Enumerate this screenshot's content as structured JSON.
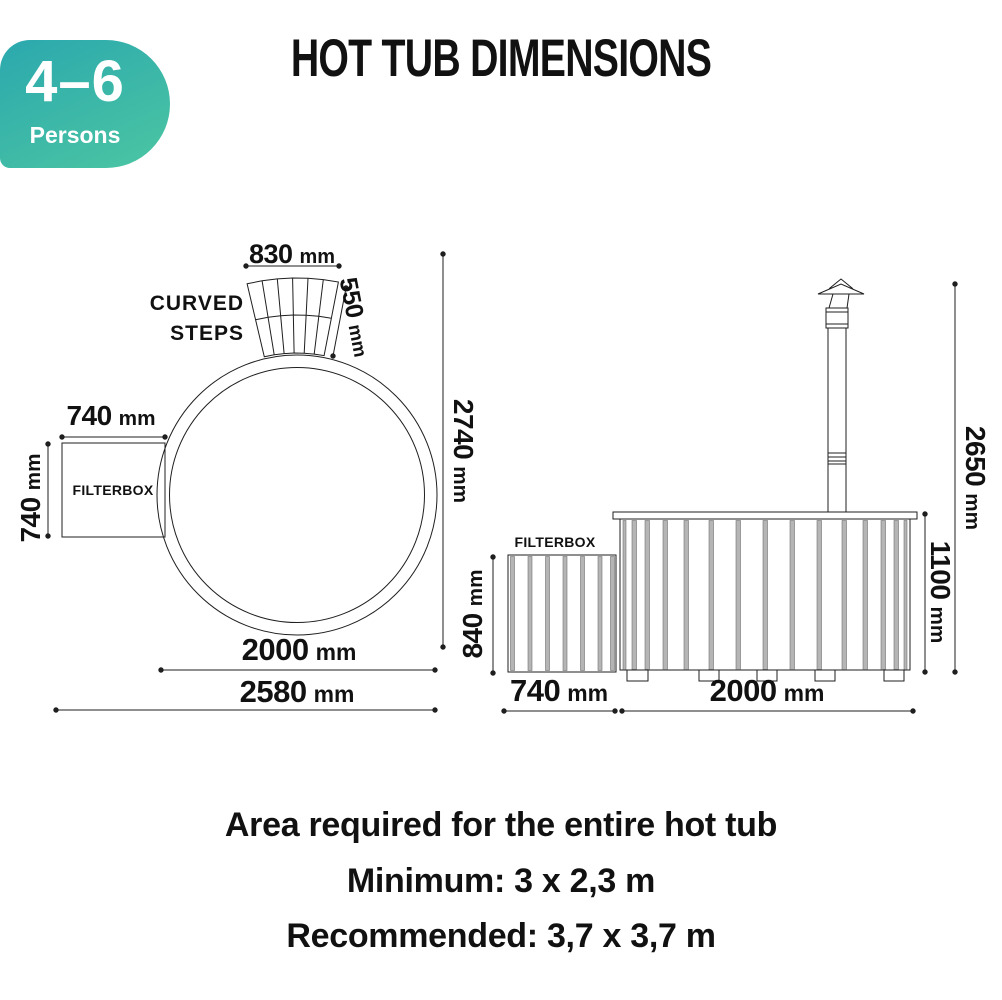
{
  "badge": {
    "range": "4–6",
    "label": "Persons"
  },
  "title": "HOT TUB DIMENSIONS",
  "top_view": {
    "steps_label": {
      "line1": "CURVED",
      "line2": "STEPS"
    },
    "filterbox_label": "FILTERBOX",
    "dims": {
      "steps_width": {
        "value": "830",
        "unit": "mm"
      },
      "steps_depth": {
        "value": "550",
        "unit": "mm"
      },
      "filterbox_width": {
        "value": "740",
        "unit": "mm"
      },
      "filterbox_depth": {
        "value": "740",
        "unit": "mm"
      },
      "tub_diameter": {
        "value": "2000",
        "unit": "mm"
      },
      "total_width": {
        "value": "2580",
        "unit": "mm"
      },
      "total_depth": {
        "value": "2740",
        "unit": "mm"
      }
    }
  },
  "side_view": {
    "filterbox_label": "FILTERBOX",
    "dims": {
      "filterbox_height": {
        "value": "840",
        "unit": "mm"
      },
      "filterbox_width": {
        "value": "740",
        "unit": "mm"
      },
      "tub_width": {
        "value": "2000",
        "unit": "mm"
      },
      "tub_height": {
        "value": "1100",
        "unit": "mm"
      },
      "total_height": {
        "value": "2650",
        "unit": "mm"
      }
    }
  },
  "footer": {
    "line1": "Area required for the entire hot tub",
    "line2": "Minimum: 3 x 2,3 m",
    "line3": "Recommended: 3,7 x 3,7 m"
  },
  "colors": {
    "badge_gradient": "linear-gradient(155deg, #2ba8ae 0%, #4cc6a2 100%)",
    "badge_gradient_start": "#2ba8ae",
    "badge_gradient_end": "#4cc6a2",
    "line": "#1f1f1f",
    "slat_gray": "#b5b5b5",
    "text": "#111111"
  }
}
